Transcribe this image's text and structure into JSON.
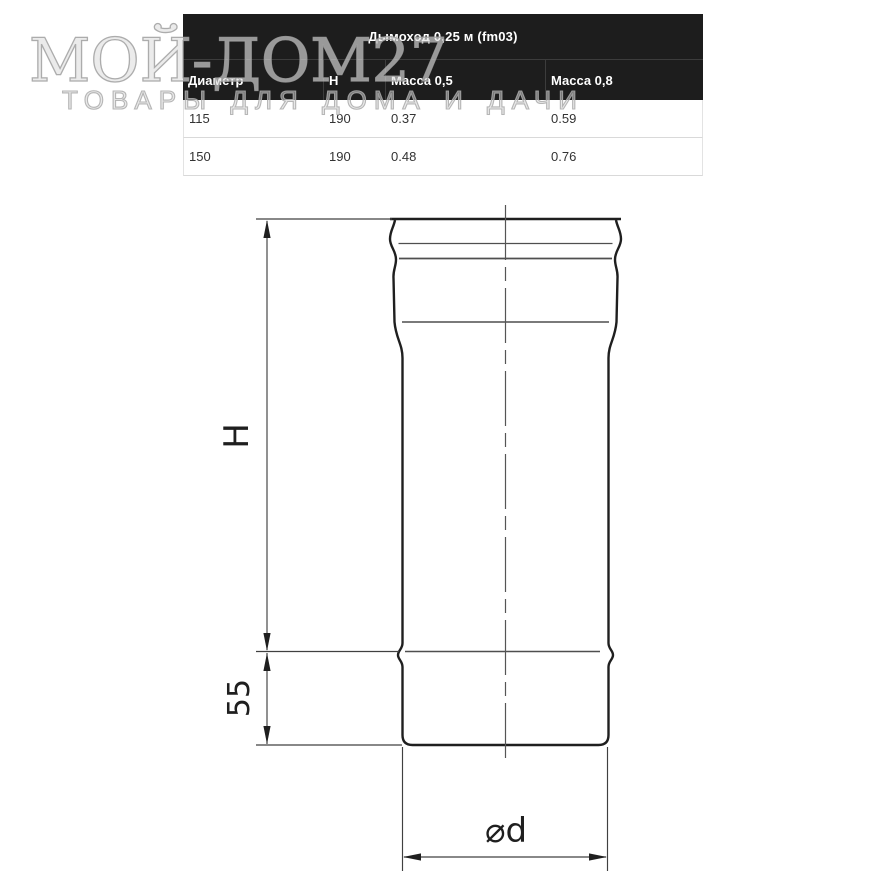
{
  "watermark": {
    "title": "МОЙ-ДОМ27",
    "subtitle": "ТОВАРЫ ДЛЯ ДОМА И ДАЧИ"
  },
  "spec_table": {
    "title": "Дымоход 0,25 м (fm03)",
    "columns": [
      "Диаметр",
      "Н",
      "Масса 0,5",
      "Масса 0,8"
    ],
    "rows": [
      [
        "115",
        "190",
        "0.37",
        "0.59"
      ],
      [
        "150",
        "190",
        "0.48",
        "0.76"
      ]
    ],
    "colors": {
      "header_bg": "#1d1d1d",
      "header_text": "#ffffff",
      "row_text": "#333333",
      "row_divider": "#d9d9d9"
    }
  },
  "drawing": {
    "type": "technical-diagram",
    "subject": "chimney pipe straight section with flared socket end",
    "dimension_labels": {
      "height": "H",
      "socket_depth": "55",
      "diameter": "⌀d"
    },
    "colors": {
      "outline": "#1f1f1f",
      "thin_line": "#4a4a4a"
    }
  }
}
